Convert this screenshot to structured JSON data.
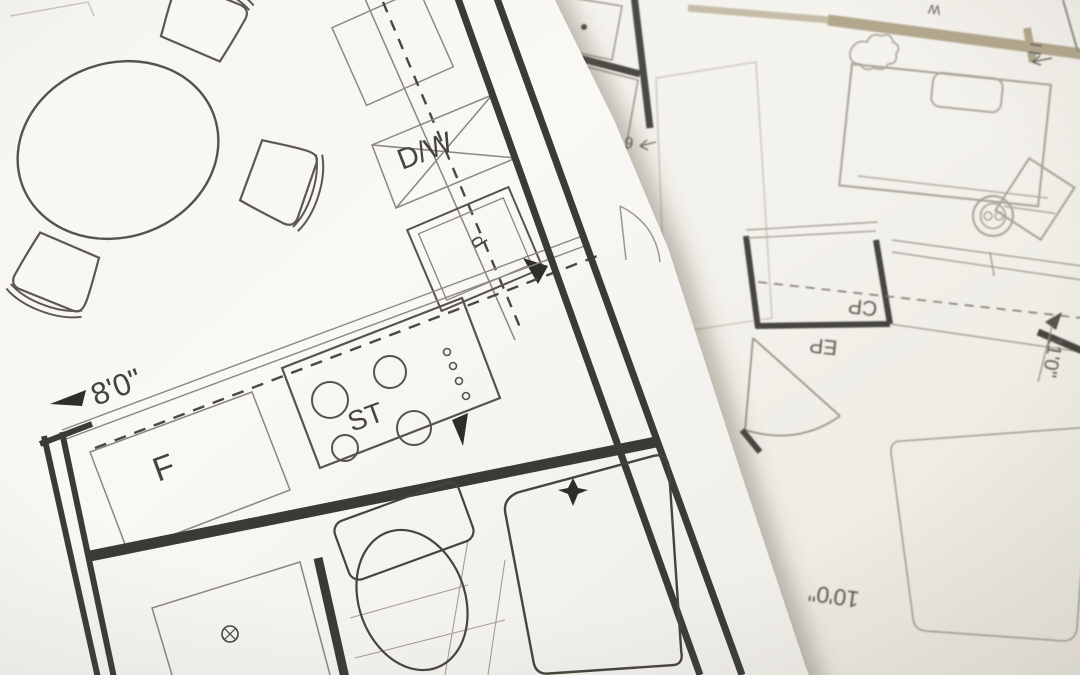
{
  "photo_subject": "floor-plan-blueprints",
  "colors": {
    "paper_left": "#f8f7f3",
    "paper_right": "#f3f1eb",
    "ink_dark": "#3b3a34",
    "ink_mid": "#8a877d",
    "ink_light": "#a9a499",
    "wall_highlight_tan": "#b3a78e"
  },
  "left_plan": {
    "labels": {
      "dishwasher": "D/W",
      "stove": "ST",
      "fridge": "F",
      "sink_letter": "d",
      "width_dimension": "8'0\""
    }
  },
  "right_plan": {
    "labels": {
      "closet": "CP",
      "entry": "EP",
      "small_room_letter": "P",
      "wall_mark": "W",
      "dim_side": "11'0\"",
      "dim_bottom": "10'0\"",
      "dim_top": "6'0\""
    }
  }
}
